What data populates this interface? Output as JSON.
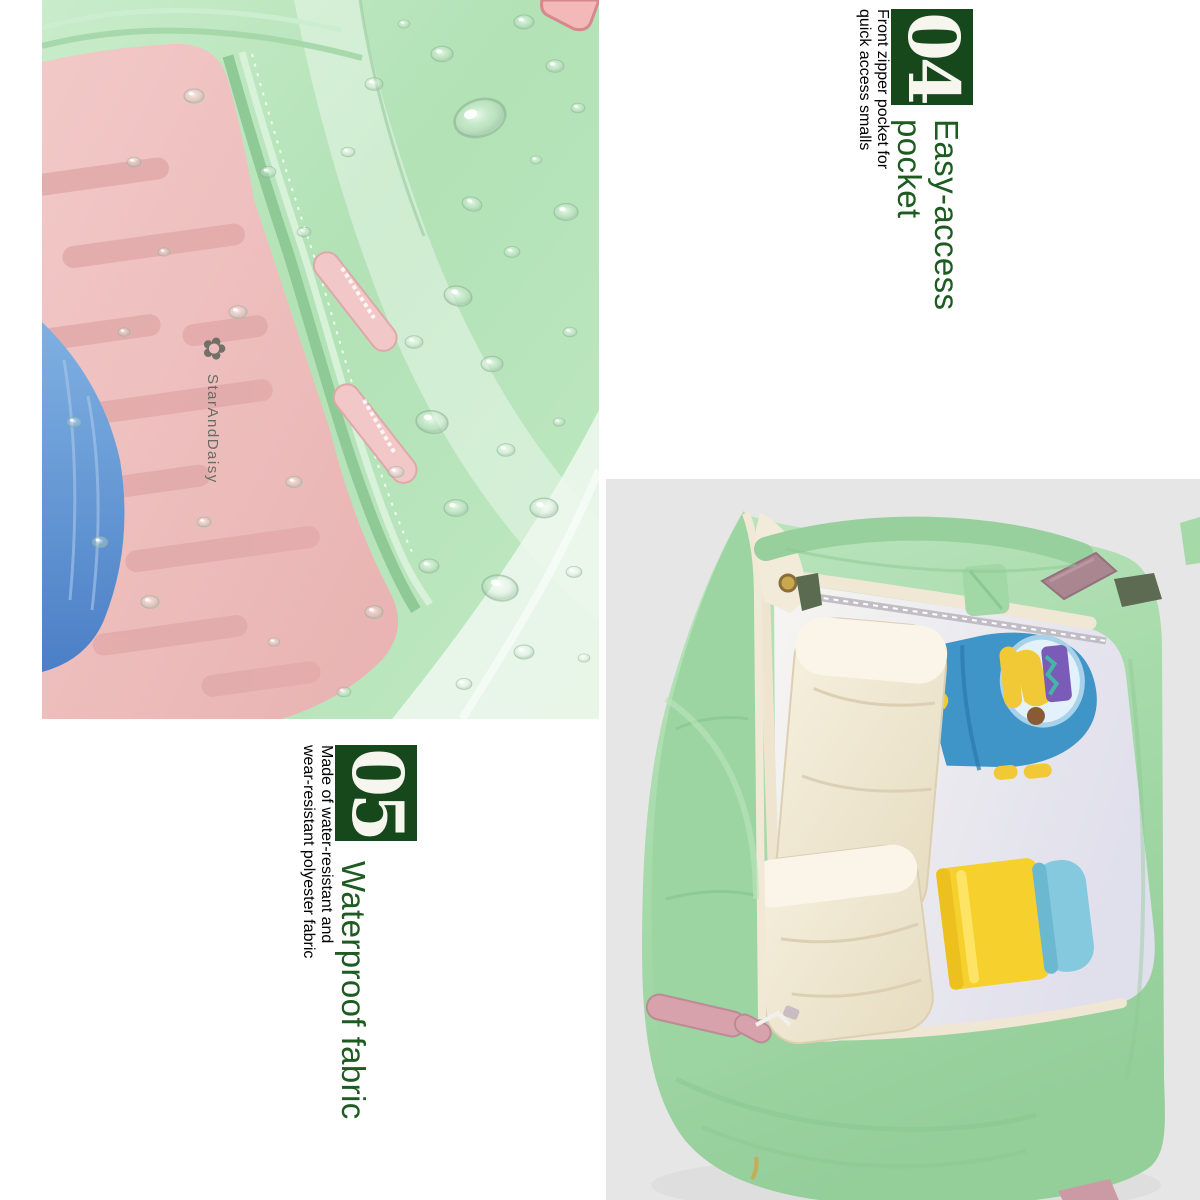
{
  "page": {
    "background": "#ffffff"
  },
  "brand": {
    "logo_text": "StarAndDaisy"
  },
  "sections": [
    {
      "badge": "04",
      "title_lines": [
        "Easy-access",
        "pocket"
      ],
      "description_lines": [
        "Front zipper pocket for",
        "quick access smalls"
      ]
    },
    {
      "badge": "05",
      "title_lines": [
        "Waterproof fabric"
      ],
      "description_lines": [
        "Made of water-resistant and",
        "wear-resistant polyester fabric"
      ]
    }
  ],
  "photos": [
    {
      "name": "waterproof-fabric-closeup"
    },
    {
      "name": "open-backpack-top-view"
    }
  ],
  "colors": {
    "badge_bg": "#17481c",
    "title_green": "#1d5b21",
    "body_green": "#4f9c53",
    "mint_fabric": "#b7e4ba",
    "pink_panel": "#efc3c2",
    "photo_bg_gray": "#e6e6e6"
  }
}
